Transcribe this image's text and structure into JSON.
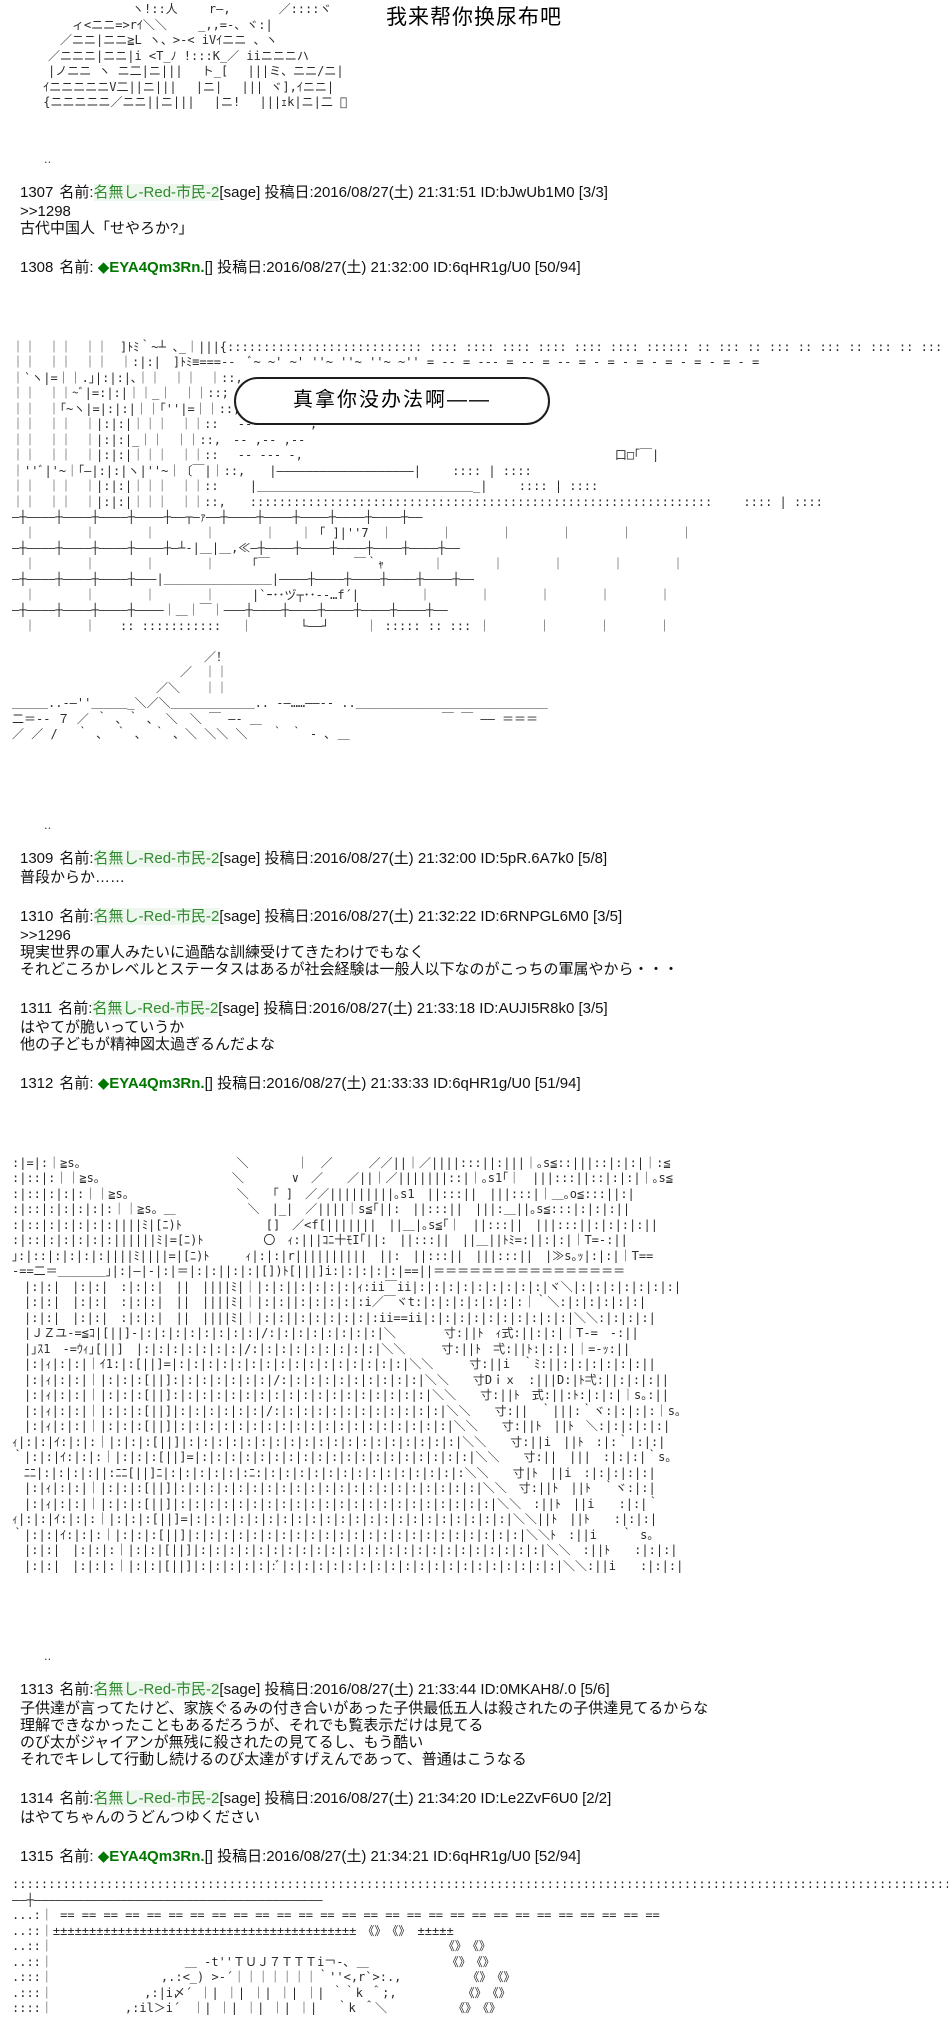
{
  "page": {
    "title": "我来帮你换尿布吧",
    "bubble_text": "真拿你没办法啊——",
    "dots": ".."
  },
  "colors": {
    "name_green": "#2e8b2e",
    "trip_green": "#007700",
    "text": "#111111",
    "background": "#ffffff"
  },
  "aa": {
    "top": [
      "　　　　　　　　　ヽ!::人　　 r―,　　　　／::::ヾ",
      "　　　　ィ<ニニ=>rｲ＼＼　　 _,,=-、ヾ:|",
      "　　　／ニニ|ニニ≧L ヽ、>-< iVｲニニ 、ヽ",
      "　　／ニニニ|ニニ|i <T_ﾉ !:::K_／ iiニニニハ",
      "　　|ノニニ ヽ ニ二|ニ|||　 ト_[　 |||ミ、ニニ/ニ|",
      "　 ｲニニニニニV二||ニ|||　 |ニ|　 ||| ヾ],ｲニニ|",
      "　 {ニニニニニ／ニニ||ニ||| 　|ニ!　 |||ｪk|ニ|二 ゙"
    ],
    "block1": [
      "｜｜　｜｜　｜｜　]ﾄﾐ｀~┴ ､_｜|||{::::::::::::::::::::::::::: :::: :::: :::: :::: :::: :::: :::::: :: ::: :: ::: :: ::: :: ::: :: ::: :: ::: :: ::: :: :::",
      "｜｜　｜｜　｜｜　｜:|:|　]ﾄﾐ≡===--　ﾞ~ ~' ~' ''~ ''~ ''~ ~'' = -- = --- = -- = -- = - = - = - = - = - = - =",
      "｜`ヽ|=｜｜.｣|:|:|､｜｜　｜｜　｜::,　-- -- ----",
      "｜｜　｜｜~ﾞ|=:|:|｜｜_｜　｜｜::;　-- -- -- --",
      "｜｜　｜｢~ヽ|=|:|:|｜｜｢''|=｜｜::,　-- -- - --",
      "｜｜　｜｜　｜|:|:|｜｜｜　｜｜::　 -- ~--- ~-,",
      "｜｜　｜｜　｜|:|:|_｜｜　｜｜::,　-- ,-- ,--",
      "｜｜　｜｜　｜|:|:|｜｜｜　｜｜::　 -- --- -,　　　　　　　　　　　　　　　　　　　　　　　　　　口□｢￣|",
      "｜''ﾞ|'~｜｢―|:|:|ヽ|''~｜〔￣|｜::,　　|―――――――――――――――――――|　　 :::: | ::::",
      "｜｜　｜｜　｜|:|:|｜｜｜　｜｜::　　 |＿＿＿＿＿＿＿＿＿＿＿＿＿＿＿＿＿＿_|　　 :::: | ::::",
      "｜｜　｜｜　｜|:|:|｜｜｜　｜｜::,　　::::::::::::::::::::::::::::::::::::::::::::::::::::::::::::::::　　 :::: | ::::",
      "―┼――――┼――――┼――――┼――――┼――┬―ｧ――┼――――┼――――┼――――┼――――┼――――┼――",
      "　｜　　　　｜　　　　｜　　　　｜　　　　｜　　｜ ｢ ]|''7　｜　　　　｜　　　　｜　　　　｜　　　　｜　　　　｜",
      "―┼――――┼――――┼――――┼――――┼―┴-|＿|＿,≪―┼――――┼――――┼――――┼――――┼――――┼――",
      "　｜　　　　｜　　　　｜　　　　｜　　　｢￣　　　　　　　￣｀ｬ　　　　｜　　　　｜　　　　｜　　　　｜　　　　｜",
      "―┼――――┼――――┼――――┼―――|＿＿＿＿＿＿＿＿＿|――――┼――――┼――――┼――――┼――――┼――",
      "　｜　　　　｜　　　　｜　　　　｜　　　|`ｰ･･ヅ┬･･-‐…f´|　　　　　｜　　　　｜　　　　｜　　　　｜　　　　｜",
      "―┼――――┼――――┼――――┼――――｜＿｜￣｜―――┼――――┼――――┼――――┼――――┼――――┼――",
      "　｜　　　　｜　　:: ::::::::::: 　｜　　　　└――┘　　　｜ ::::: :: ::: ｜　　　　｜　　　　｜　　　　｜",
      "",
      "　　　　　　　　　　　　　　　　／！",
      "　　　　　　　　　　　　　　／　｜｜",
      "　　　　　　　　　　　　／＼　　｜｜",
      "＿＿＿..-―''＿＿＿_＼／＼＿＿＿＿＿＿＿.. -―……――-- ..＿＿＿＿＿＿＿＿＿＿＿＿＿＿＿＿",
      "二＝-‐ ７ ／ ｀ 、｀ 、 ＼　＼ ￣ ―- ＿　　　　　　　　　　　　　　　￣ ￣ ―― ＝＝＝",
      "／ ／ /　 ｀ 、 ｀ 、 ｀ 、＼ ＼＼ ＼　　｀ ｀ - ､ ＿"
    ],
    "block2": [
      ":|=|:｜≧s。　　　　　　　　　　　　　＼　　　　｜　／　　　／／||｜／||||:::||:|||｜｡s≦::|||::|:|:|｜:≦",
      ":|::|:｜｜≧s。　　　　　　　　　　　＼　　　　∨　／　　／||｜／|||||||::|｜｡s1｢｜　|||:::||::|:|:|｜｡s≦",
      ":|::|:|:|:｜｜≧s。　　　　　　　　　＼　　｢ ]　／／|||||||||｡s1　||:::||　|||:::|｜＿｡o≦:::||:|",
      ":|::|:|:|:|:|:｜｜≧s。＿　　　　　　＼　|_|　／||||｜s≦｢||:　||:::||　|||:＿||｡s≦:::|:|:|:||",
      ":|::|:|:|:|:|:||||ﾐ|[ﾆ)ﾄ　　　　　　　[]　／<f[|||||||　||＿|｡s≦｢｜　||:::||　|||:::||:|:|:|:||",
      ":|::|:|:|:|:|:||||||ﾐ|=[ﾆ)ﾄ　　　　　〇　ｨ:|||ｺﾆ十ﾓI｢||:　||:::||　||＿||ﾄﾐ=:||:|:|｜T=-:||",
      "｣:|::|:|:|:|:||||ﾐ||||=|[ﾆ)ﾄ　　　ｨ|:|:|r||||||||||　||:　||:::||　|||:::||　|≫s｡ｯ|:|:|｜T==",
      "-==二＝＿＿＿＿｣|:|―|-|:|＝|:|:||:|:|[])ﾄ[|||]i:|:|:|:|:|==||＝＝＝＝＝＝＝＝＝＝＝＝＝＝＝＝",
      "　|:|:|　|:|:|　:|:|:|　||　||||ﾐ|｜|:|:||:|:|:|:|ｨ:ii￣ii|:|:|:|:|:|:|:|:|:|ヾ＼|:|:|:|:|:|:|:|",
      "　|:|:|　|:|:|　:|:|:|　||　||||ﾐ|｜|:|:||:|:|:|:|:i／￣ヾt:|:|:|:|:|:|:|:｜｀＼:|:|:|:|:|:|",
      "　|:|:|　|:|:|　:|:|:|　||　||||ﾐ|｜|:|:||:|:|:|:|:|:ii==ii|:|:|:|:|:|:|:|:|:|:|＼＼:|:|:|:|",
      "　|ＪＺユ-=≦ｺ|[||]-|:|:|:|:|:|:|:|:|/:|:|:|:|:|:|:|:|＼　　　　寸:||ﾄ　ｨ式:||:|:|｜T-=　-:||",
      "　|｣ｽ1　-=ｳｨ｣[||]　|:|:|:|:|:|:|:|/:|:|:|:|:|:|:|:|:|＼＼　　　寸:||ﾄ　弌:||ﾄ:|:|:|｜=-ｯ:||",
      "　|:|ｨ|:|:|｜ｲ1:|:[||]=|:|:|:|:|:|:|:|:|:|:|:|:|:|:|:|:|＼＼　　　寸:||i　｀ﾐ:||:|:|:|:|:|:||",
      "　|:|ｨ|:|:|｜|:|:|:[||]:|:|:|:|:|:|:|/:|:|:|:|:|:|:|:|:|:|＼＼　　寸Dｉｘ　:|||D:|ﾄ弌:||:|:|:||",
      "　|:|ｨ|:|:|｜|:|:|:[||]:|:|:|:|:|:|:|:|:|:|:|:|:|:|:|:|:|:|＼＼　　寸:||ﾄ　式:||:ﾄ:|:|:|｜s｡:||",
      "　|:|ｨ|:|:|｜|:|:|:[||]|:|:|:|:|:|:|/:|:|:|:|:|:|:|:|:|:|:|:|＼＼　　寸:||　｀|||:｀ヾ:|:|:|:｜s｡",
      "　|:|ｨ|:|:|｜|:|:|:[||]|:|:|:|:|:|:|:|:|:|:|:|:|:|:|:|:|:|:|:|＼＼　　寸:||ﾄ　||ﾄ　＼:|:|:|:|:|",
      "ｨ|:|:|ｲ:|:|:｜|:|:|:[||]|:|:|:|:|:|:|:|:|:|:|:|:|:|:|:|:|:|:|:|＼＼　　寸:||i　||ﾄ　:|:｀|:|:|",
      "｀|:|:|ｲ:|:|:｜|:|:|:[||]=|:|:|:|:|:|:|:|:|:|:|:|:|:|:|:|:|:|:|:|＼＼　　寸:||　|||　:|:|:|｀s｡",
      "　ﾆﾆ|:|:|:|:||:ﾆﾆ[||]ﾆ|:|:|:|:|:|:ﾆ:|:|:|:|:|:|:|:|:|:|:|:|:|:|:＼＼　　寸|ﾄ　||i　:|:|:|:|:|",
      "　|:|ｨ|:|:|｜|:|:|:[||]|:|:|:|:|:|:|:|:|:|:|:|:|:|:|:|:|:|:|:|:|:|＼＼　寸:||ﾄ　||ﾄ　｀ヾ:|:|",
      "　|:|ｨ|:|:|｜|:|:|:[||]|:|:|:|:|:|:|:|:|:|:|:|:|:|:|:|:|:|:|:|:|:|:|＼＼　:||ﾄ　||i　　:|:|｀",
      "ｨ|:|:|ｲ:|:|:｜|:|:|:[||]=|:|:|:|:|:|:|:|:|:|:|:|:|:|:|:|:|:|:|:|:|:|:|＼＼||ﾄ　||ﾄ　　:|:|:|",
      "｀|:|:|ｲ:|:|:｜|:|:|:[||]|:|:|:|:|:|:|:|:|:|:|:|:|:|:|:|:|:|:|:|:|:|:|:|＼＼ﾄ　:||i　　｀ s｡",
      "　|:|:|　|:|:|:｜|:|:|[||]|:|:|:|:|:|:|:|:|:|:|:|:|:|:|:|:|:|:|:|:|:|:|:|:|＼＼　:||ﾄ　　:|:|:|",
      "　|:|:|　|:|:|:｜|:|:|[||]|:|:|:|:|:|:ﾞ|:|:|:|:|:|:|:|:|:|:|:|:|:|:|:|:|:|:|:|＼＼:||i　　:|:|:|"
    ],
    "block3": [
      "::::::::::::::::::::::::::::::::::::::::::::::::::::::::::::::::::::::::::::::::::::::::::::::::::::::::::::::::::::::::::::::::::::::::::::",
      "――┼――――――――――――――――――――――――――――――――――――――――",
      "...:｜ == == == == == == == == == == == == == == == == == == == == == == == == == == == ==",
      "..::｜±±±±±±±±±±±±±±±±±±±±±±±±±±±±±±±±±±±±±±±±±±　《》　《》 ±±±±±",
      "..::｜　　　　　　　　　　　　　　　　　　　　　　　　　　　　　　　　　《》　《》",
      "..::｜　　　　　　　　　　　＿ -t''ＴＵＪ７ＴＴＴi￢-､ ＿　　　　　　　《》　《》",
      ".:::｜　　　　　　　　　,.:<_) >-´｜｜｜｜｜｜｜｀''<,r`>:.,　　　　　　《》　《》",
      ".:::｜　　　　　　　 ,:|i〆´ ｜| ｜| ｜| ｜| ｜| ｀｀k ＾;,　　　　　　《》　《》",
      "::::｜　　　　　　,:il＞i´　｜| ｜| ｜| ｜| ｜| 　｀k ＾＼　　　　　　《》　《》"
    ]
  },
  "posts": [
    {
      "type": "dots"
    },
    {
      "type": "post",
      "no": "1307",
      "name_label": "名前:",
      "name": "名無し-Red-市民-2",
      "trip": false,
      "mail": "[sage]",
      "tail": " 投稿日:2016/08/27(土) 21:31:51 ID:bJwUb1M0 [3/3]",
      "body": [
        ">>1298",
        "古代中国人「せやろか?」"
      ]
    },
    {
      "type": "post",
      "no": "1308",
      "name_label": "名前: ",
      "name": "◆EYA4Qm3Rn.",
      "trip": true,
      "mail": "[]",
      "tail": " 投稿日:2016/08/27(土) 21:32:00 ID:6qHR1g/U0 [50/94]",
      "body": [],
      "aa": "block1",
      "bubble": true
    },
    {
      "type": "dots"
    },
    {
      "type": "post",
      "no": "1309",
      "name_label": "名前:",
      "name": "名無し-Red-市民-2",
      "trip": false,
      "mail": "[sage]",
      "tail": " 投稿日:2016/08/27(土) 21:32:00 ID:5pR.6A7k0 [5/8]",
      "body": [
        "普段からか……"
      ]
    },
    {
      "type": "post",
      "no": "1310",
      "name_label": "名前:",
      "name": "名無し-Red-市民-2",
      "trip": false,
      "mail": "[sage]",
      "tail": " 投稿日:2016/08/27(土) 21:32:22 ID:6RNPGL6M0 [3/5]",
      "body": [
        ">>1296",
        "現実世界の軍人みたいに過酷な訓練受けてきたわけでもなく",
        "それどころかレベルとステータスはあるが社会経験は一般人以下なのがこっちの軍属やから・・・"
      ]
    },
    {
      "type": "post",
      "no": "1311",
      "name_label": "名前:",
      "name": "名無し-Red-市民-2",
      "trip": false,
      "mail": "[sage]",
      "tail": " 投稿日:2016/08/27(土) 21:33:18 ID:AUJI5R8k0 [3/5]",
      "body": [
        "はやてが脆いっていうか",
        "他の子どもが精神図太過ぎるんだよな"
      ]
    },
    {
      "type": "post",
      "no": "1312",
      "name_label": "名前: ",
      "name": "◆EYA4Qm3Rn.",
      "trip": true,
      "mail": "[]",
      "tail": " 投稿日:2016/08/27(土) 21:33:33 ID:6qHR1g/U0 [51/94]",
      "body": [],
      "aa": "block2"
    },
    {
      "type": "dots"
    },
    {
      "type": "post",
      "no": "1313",
      "name_label": "名前:",
      "name": "名無し-Red-市民-2",
      "trip": false,
      "mail": "[sage]",
      "tail": " 投稿日:2016/08/27(土) 21:33:44 ID:0MKAH8/.0 [5/6]",
      "body": [
        "子供達が言ってたけど、家族ぐるみの付き合いがあった子供最低五人は殺されたの子供達見てるからな",
        "理解できなかったこともあるだろうが、それでも覧表示だけは見てる",
        "のび太がジャイアンが無残に殺されたの見てるし、もう酷い",
        "それでキレして行動し続けるのび太達がすげえんであって、普通はこうなる"
      ]
    },
    {
      "type": "post",
      "no": "1314",
      "name_label": "名前:",
      "name": "名無し-Red-市民-2",
      "trip": false,
      "mail": "[sage]",
      "tail": " 投稿日:2016/08/27(土) 21:34:20 ID:Le2ZvF6U0 [2/2]",
      "body": [
        "はやてちゃんのうどんつゆください"
      ]
    },
    {
      "type": "post",
      "no": "1315",
      "name_label": "名前: ",
      "name": "◆EYA4Qm3Rn.",
      "trip": true,
      "mail": "[]",
      "tail": " 投稿日:2016/08/27(土) 21:34:21 ID:6qHR1g/U0 [52/94]",
      "body": [],
      "aa": "block3"
    }
  ]
}
